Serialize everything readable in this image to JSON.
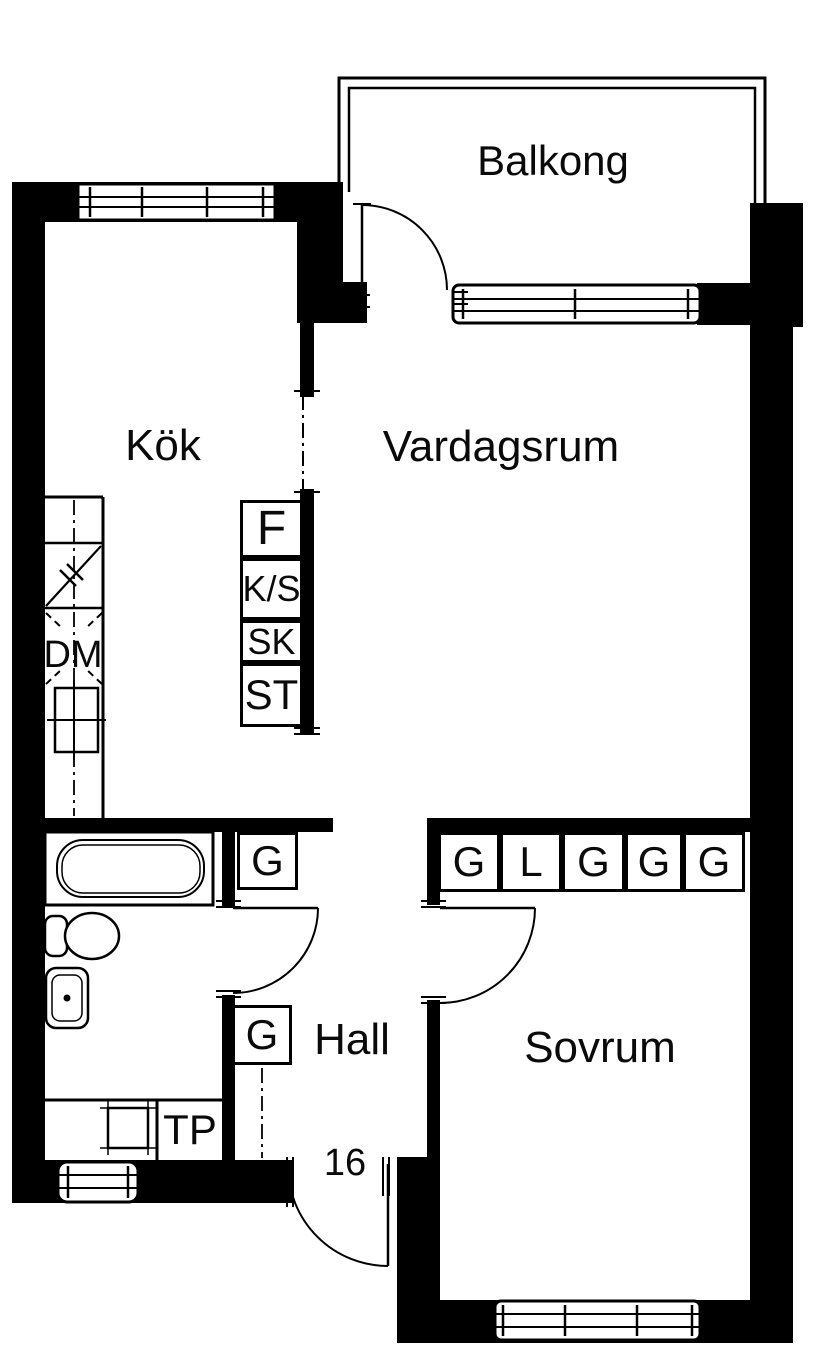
{
  "plan": {
    "rooms": {
      "balcony": "Balkong",
      "kitchen": "Kök",
      "living_room": "Vardagsrum",
      "hall": "Hall",
      "bedroom": "Sovrum"
    },
    "appliances": {
      "dishwasher": "DM",
      "drying_cabinet": "TP"
    },
    "entrance_number": "16",
    "kitchen_cabinets": [
      "F",
      "K/S",
      "SK",
      "ST"
    ],
    "bedroom_closets": [
      "G",
      "L",
      "G",
      "G",
      "G"
    ],
    "bathroom_closet": "G",
    "hall_closet": "G",
    "colors": {
      "wall": "#000000",
      "background": "#ffffff",
      "line": "#000000"
    }
  }
}
